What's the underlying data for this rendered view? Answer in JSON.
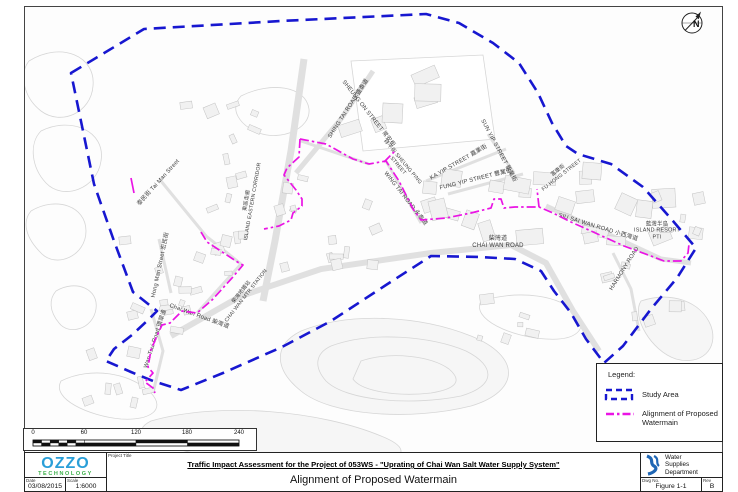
{
  "title_block": {
    "project_title_label": "Project Title",
    "title": "Traffic Impact Assessment for the Project of 053WS - \"Uprating of Chai Wan Salt Water Supply System\"",
    "subtitle": "Alignment of Proposed Watermain",
    "company_name": "OZZO",
    "company_sub": "TECHNOLOGY",
    "date_label": "Date",
    "date_value": "03/08/2015",
    "scale_label": "Scale",
    "scale_value": "1:6000",
    "department": "Water\nSupplies\nDepartment",
    "dwg_label": "Dwg No.",
    "dwg_value": "Figure 1-1",
    "rev_label": "Rev",
    "rev_value": "B"
  },
  "legend": {
    "heading": "Legend:",
    "items": [
      {
        "symbol": "study-area-dashed-rectangle",
        "label": "Study Area"
      },
      {
        "symbol": "watermain-dash-dot-line",
        "label": "Alignment of Proposed Watermain"
      }
    ]
  },
  "north_label": "N",
  "scalebar": {
    "ticks": [
      "0",
      "60",
      "120",
      "180",
      "240"
    ]
  },
  "map": {
    "colors": {
      "study_area": "#1717d0",
      "watermain": "#ea14e4"
    },
    "study_area_path": "M 70,72 L 143,28 L 280,20 L 425,13 L 458,22 L 492,42 L 518,62 L 537,92 L 551,122 L 565,145 L 577,153 L 610,163 L 642,186 L 672,220 L 695,247 L 676,277 L 650,308 L 622,345 L 603,362 L 585,338 L 570,312 L 553,290 L 540,270 L 514,258 L 478,256 L 430,255 L 385,284 L 330,320 L 281,346 L 222,372 L 180,389 L 152,380 L 130,371 L 105,360 L 113,348 L 131,334 L 147,319 L 156,310 L 132,291 L 113,240 L 93,183 Z",
    "watermain_paths": [
      "M 299,138 L 325,143 L 352,158 L 368,163 L 385,160 L 398,180 L 412,208 L 420,219 L 445,217 L 470,212 L 490,207 L 493,198 L 500,198 L 503,207 L 514,206 L 538,206 L 552,212 L 570,221 L 590,230 L 623,245 L 650,255 L 663,260 L 680,260 L 687,252 L 688,243",
      "M 383,161 L 394,150",
      "M 538,206 L 536,188",
      "M 299,138 L 298,156 L 286,167 L 283,174 L 295,189 L 301,198 L 301,205 L 292,212 L 290,219 L 278,225 L 263,228",
      "M 200,231 L 206,241 L 238,262 L 242,264 L 231,277 L 211,299 L 196,312 L 181,310 L 175,316 L 169,322 L 161,324 L 155,337 L 150,349 L 147,366 L 152,372 L 144,381 L 152,387 L 154,392",
      "M 130,177 L 133,192"
    ],
    "labels": [
      {
        "text": "SHING TAI ROAD 盛泰道",
        "x": 348,
        "y": 108,
        "rot": -57
      },
      {
        "text": "SHEUNG ON STREET 常安街",
        "x": 367,
        "y": 113,
        "rot": 52
      },
      {
        "text": "祥平街 SHEUNG PING\nSTREET",
        "x": 399,
        "y": 163,
        "rot": 50,
        "fs": 5.2
      },
      {
        "text": "KA YIP STREET 嘉業街",
        "x": 458,
        "y": 162,
        "rot": -30
      },
      {
        "text": "SUN YIP STREET 新業街",
        "x": 497,
        "y": 150,
        "rot": 62
      },
      {
        "text": "WING TAI ROAD 永泰道",
        "x": 404,
        "y": 198,
        "rot": 52
      },
      {
        "text": "FUNG YIP STREET 豐業街",
        "x": 475,
        "y": 179,
        "rot": -14
      },
      {
        "text": "富康街\nFU HONG STREET",
        "x": 559,
        "y": 172,
        "rot": -38,
        "fs": 5.2
      },
      {
        "text": "SIU SAI WAN ROAD 小西灣道",
        "x": 597,
        "y": 227,
        "rot": 17
      },
      {
        "text": "藍灣半島\nISLAND RESORT\nPTI",
        "x": 656,
        "y": 230,
        "rot": 0,
        "fs": 5.4
      },
      {
        "text": "HARMONY ROAD",
        "x": 624,
        "y": 268,
        "rot": -58
      },
      {
        "text": "柴灣道\nCHAI WAN ROAD",
        "x": 497,
        "y": 242,
        "rot": 0,
        "fs": 6
      },
      {
        "text": "柴灣地鐵站\nCHAI WAN MTR STATION",
        "x": 243,
        "y": 293,
        "rot": -52,
        "fs": 5.2
      },
      {
        "text": "Hong Man Street 宏民街",
        "x": 160,
        "y": 264,
        "rot": -78
      },
      {
        "text": "Chai Wan Road 柴灣道",
        "x": 198,
        "y": 316,
        "rot": 20
      },
      {
        "text": "Wan Tsui Road 環翠道",
        "x": 155,
        "y": 338,
        "rot": -72
      },
      {
        "text": "泰民街 Tai Man Street",
        "x": 158,
        "y": 182,
        "rot": -48
      },
      {
        "text": "東區走廊\nISLAND EASTERN CORRIDOR",
        "x": 249,
        "y": 200,
        "rot": -80,
        "fs": 5.2
      }
    ]
  }
}
